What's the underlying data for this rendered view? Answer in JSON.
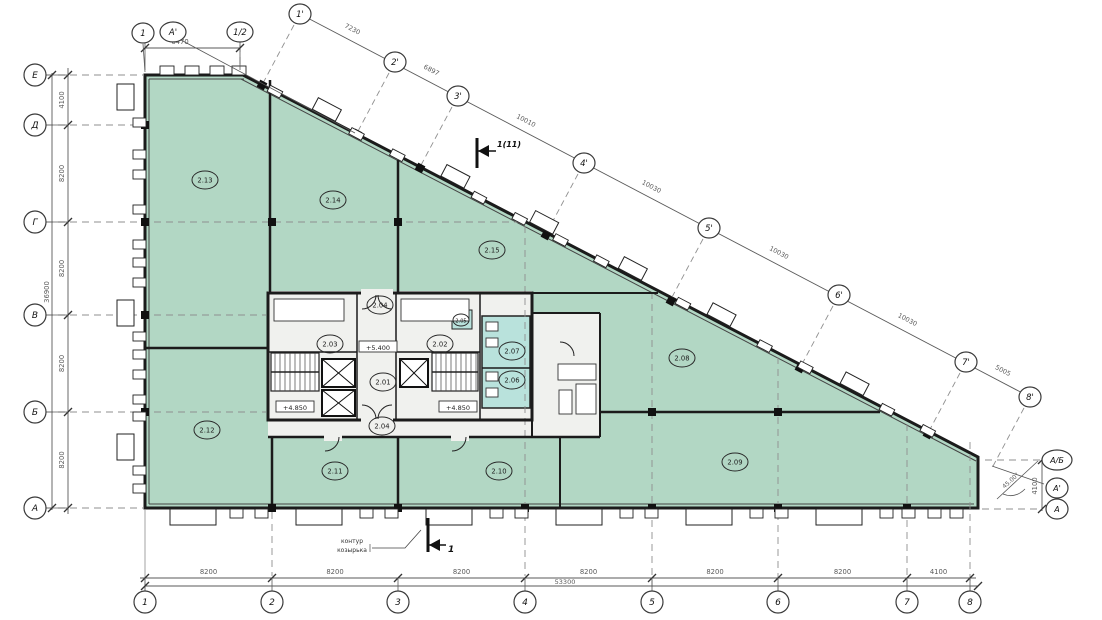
{
  "drawing": {
    "kind": "architectural-floor-plan",
    "colors": {
      "room_fill": "#b2d7c4",
      "wet_fill": "#b9e2dc",
      "core_fill": "#f0f1ee",
      "wall": "#1b1b1b",
      "dim": "#5a5a5a",
      "grid": "#8f8f8f"
    }
  },
  "rows": [
    {
      "id": "Е",
      "y": 75
    },
    {
      "id": "Д",
      "y": 125
    },
    {
      "id": "Г",
      "y": 222
    },
    {
      "id": "В",
      "y": 315
    },
    {
      "id": "Б",
      "y": 412
    },
    {
      "id": "А",
      "y": 508
    }
  ],
  "row_dims": [
    "4100",
    "8200",
    "8200",
    "8200",
    "8200"
  ],
  "row_total": "36900",
  "cols": [
    {
      "id": "1",
      "x": 145
    },
    {
      "id": "2",
      "x": 272
    },
    {
      "id": "3",
      "x": 398
    },
    {
      "id": "4",
      "x": 525
    },
    {
      "id": "5",
      "x": 652
    },
    {
      "id": "6",
      "x": 778
    },
    {
      "id": "7",
      "x": 907
    },
    {
      "id": "8",
      "x": 970
    }
  ],
  "col_dims": [
    "8200",
    "8200",
    "8200",
    "8200",
    "8200",
    "8200",
    "4100"
  ],
  "col_total": "53300",
  "top_markers": [
    {
      "id": "1",
      "x": 143,
      "y": 33
    },
    {
      "id": "А'",
      "x": 173,
      "y": 32
    },
    {
      "id": "1/2",
      "x": 240,
      "y": 32
    }
  ],
  "top_dim": "6470",
  "primes": [
    {
      "id": "1'",
      "x": 300,
      "y": 14
    },
    {
      "id": "2'",
      "x": 395,
      "y": 62
    },
    {
      "id": "3'",
      "x": 458,
      "y": 96
    },
    {
      "id": "4'",
      "x": 584,
      "y": 163
    },
    {
      "id": "5'",
      "x": 709,
      "y": 228
    },
    {
      "id": "6'",
      "x": 839,
      "y": 295
    },
    {
      "id": "7'",
      "x": 966,
      "y": 362
    },
    {
      "id": "8'",
      "x": 1030,
      "y": 397
    }
  ],
  "prime_dims": [
    "7230",
    "6897",
    "10010",
    "10030",
    "10030",
    "10030",
    "5005"
  ],
  "right_markers": [
    {
      "id": "А/Б",
      "y": 460
    },
    {
      "id": "А'",
      "y": 488
    },
    {
      "id": "А",
      "y": 509
    }
  ],
  "right_dim": "4100",
  "corner_angle": "45.00°",
  "rooms": [
    {
      "id": "2.01",
      "x": 383,
      "y": 382
    },
    {
      "id": "2.02",
      "x": 440,
      "y": 344
    },
    {
      "id": "2.03",
      "x": 330,
      "y": 344
    },
    {
      "id": "2.04",
      "x": 380,
      "y": 305
    },
    {
      "id": "2.04",
      "x": 382,
      "y": 426
    },
    {
      "id": "2.05",
      "x": 461,
      "y": 320
    },
    {
      "id": "2.06",
      "x": 512,
      "y": 380
    },
    {
      "id": "2.07",
      "x": 512,
      "y": 351
    },
    {
      "id": "2.08",
      "x": 682,
      "y": 358
    },
    {
      "id": "2.09",
      "x": 735,
      "y": 462
    },
    {
      "id": "2.10",
      "x": 499,
      "y": 471
    },
    {
      "id": "2.11",
      "x": 335,
      "y": 471
    },
    {
      "id": "2.12",
      "x": 207,
      "y": 430
    },
    {
      "id": "2.13",
      "x": 205,
      "y": 180
    },
    {
      "id": "2.14",
      "x": 333,
      "y": 200
    },
    {
      "id": "2.15",
      "x": 492,
      "y": 250
    }
  ],
  "levels": [
    {
      "label": "+5.400",
      "x": 378,
      "y": 347
    },
    {
      "label": "+4.850",
      "x": 295,
      "y": 407
    },
    {
      "label": "+4.850",
      "x": 458,
      "y": 407
    }
  ],
  "sections": [
    {
      "label": "1(11)",
      "x": 477,
      "y": 151
    },
    {
      "label": "1",
      "x": 428,
      "y": 545
    }
  ],
  "note": {
    "line1": "контур",
    "line2": "козырька"
  }
}
